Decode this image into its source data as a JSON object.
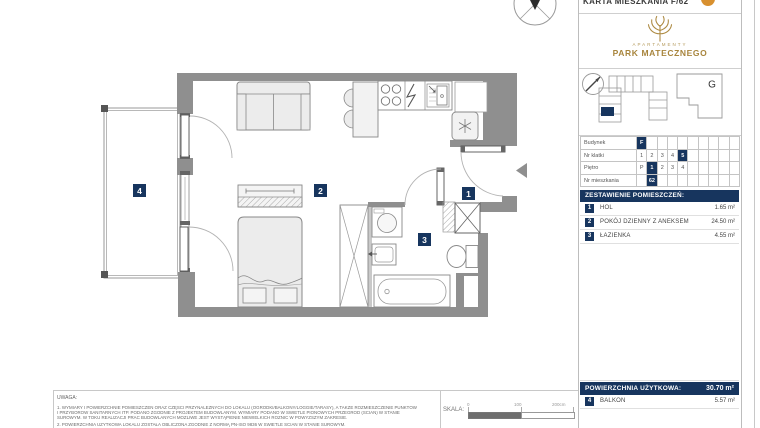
{
  "header": {
    "doc_title": "KARTA MIESZKANIA F/62",
    "logo_small": "APARTAMENTY",
    "logo_big": "PARK MATECZNEGO",
    "building_g": "G"
  },
  "colors": {
    "navy": "#17355e",
    "gold": "#ad8a42",
    "wall_gray": "#8f8f8f",
    "logo_orange": "#d8902f"
  },
  "info_table": {
    "columns": 10,
    "rows": [
      {
        "label": "Budynek",
        "cells": [
          "F",
          "",
          "",
          "",
          "",
          "",
          "",
          "",
          "",
          ""
        ],
        "highlight": 0
      },
      {
        "label": "Nr klatki",
        "cells": [
          "1",
          "2",
          "3",
          "4",
          "5",
          "",
          "",
          "",
          "",
          ""
        ],
        "highlight": 4
      },
      {
        "label": "Piętro",
        "cells": [
          "P",
          "1",
          "2",
          "3",
          "4",
          "",
          "",
          "",
          "",
          ""
        ],
        "highlight": 1
      },
      {
        "label": "Nr mieszkania",
        "cells": [
          "",
          "62",
          "",
          "",
          "",
          "",
          "",
          "",
          "",
          ""
        ],
        "highlight": 1
      }
    ]
  },
  "rooms": {
    "title": "ZESTAWIENIE POMIESZCZEŃ:",
    "items": [
      {
        "no": "1",
        "name": "HOL",
        "area": "1.65 m²"
      },
      {
        "no": "2",
        "name": "POKÓJ DZIENNY Z ANEKSEM",
        "area": "24.50 m²"
      },
      {
        "no": "3",
        "name": "ŁAZIENKA",
        "area": "4.55 m²"
      }
    ]
  },
  "summary": {
    "label": "POWIERZCHNIA UŻYTKOWA:",
    "value": "30.70 m²",
    "extra": {
      "no": "4",
      "name": "BALKON",
      "area": "5.57 m²"
    }
  },
  "plan": {
    "room_labels": [
      "1",
      "2",
      "3",
      "4"
    ]
  },
  "scale": {
    "label": "SKALA:",
    "t0": "0",
    "t100": "100",
    "t200": "200cm"
  },
  "notes": {
    "title": "UWAGA:",
    "lines": [
      "1. WYMIARY I POWIERZCHNIE POMIESZCZEŃ ORAZ CZĘŚCI PRZYNALEŻNYCH DO LOKALU (OGRÓDKI/BALKONY/LOGGIE/TARASY), A TAKŻE ROZMIESZCZENIE PUNKTÓW",
      "I PRZYBORÓW SANITARNYCH ITP. PODANO ZGODNIE Z PROJEKTEM BUDOWLANYM. WYMIARY PODANO W ŚWIETLE PIONOWYCH PRZEGRÓD (ŚCIAN) W STANIE",
      "SUROWYM. W TOKU REALIZACJI PRAC BUDOWLANYCH MOŻLIWE JEST WYSTĄPIENIE NIEWIELKICH RÓŻNIC W POWYŻSZYM ZAKRESIE.",
      "2. POWIERZCHNIA UŻYTKOWA LOKALU ZOSTAŁA OBLICZONA ZGODNIE Z NORMĄ PN-ISO 9836 W ŚWIETLE ŚCIAN W STANIE SUROWYM."
    ]
  }
}
